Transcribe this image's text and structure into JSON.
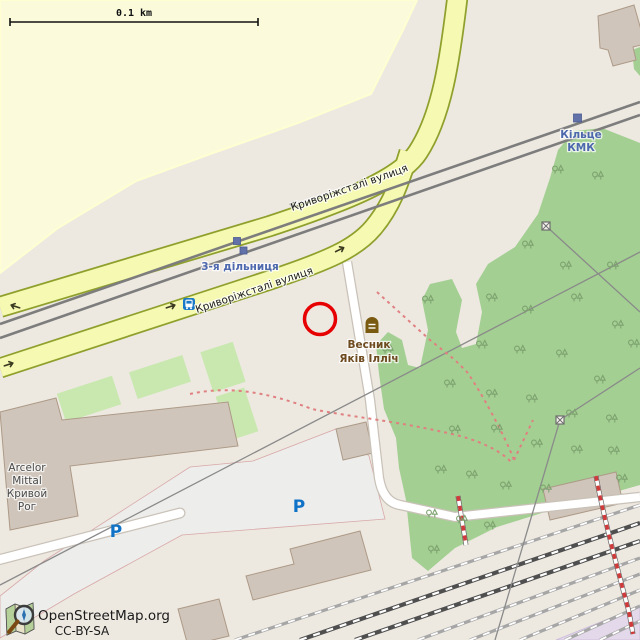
{
  "map": {
    "scale_bar": {
      "label": "0.1 km"
    },
    "streets": {
      "upper_label": "Криворіжсталі вулиця",
      "lower_label": "Криворіжсталі вулиця"
    },
    "transit": {
      "stop_label": "3-я дільниця",
      "terminus_label_line1": "Кільце",
      "terminus_label_line2": "КМК"
    },
    "poi": {
      "memorial_line1": "Весник",
      "memorial_line2": "Яків Ілліч"
    },
    "landmarks": {
      "factory_line1": "Arcelor",
      "factory_line2": "Mittal",
      "factory_line3": "Кривой",
      "factory_line4": "Рог",
      "parking_symbol": "P"
    },
    "attribution": {
      "line1": "OpenStreetMap.org",
      "line2": "CC-BY-SA"
    },
    "icons": {
      "bus_stop": "bus-stop-icon",
      "tram_stop": "tram-stop-square",
      "memorial": "memorial-icon",
      "pylon": "power-pylon-icon"
    },
    "colors": {
      "background": "#ede9e1",
      "field": "#fbfbdc",
      "park_green": "#a3cf92",
      "grass_green": "#c9e8af",
      "road_fill": "#f6f9b2",
      "road_casing": "#8fa02c",
      "building": "#d0c5ba",
      "parking_area": "#ededeb",
      "industrial_purple": "#e4d9ea",
      "transit_blue": "#4d68ad",
      "parking_blue": "#0f72c6",
      "memorial_brown": "#6e4a1f",
      "annotation_red": "#e60000",
      "path_red": "#e08080"
    }
  }
}
